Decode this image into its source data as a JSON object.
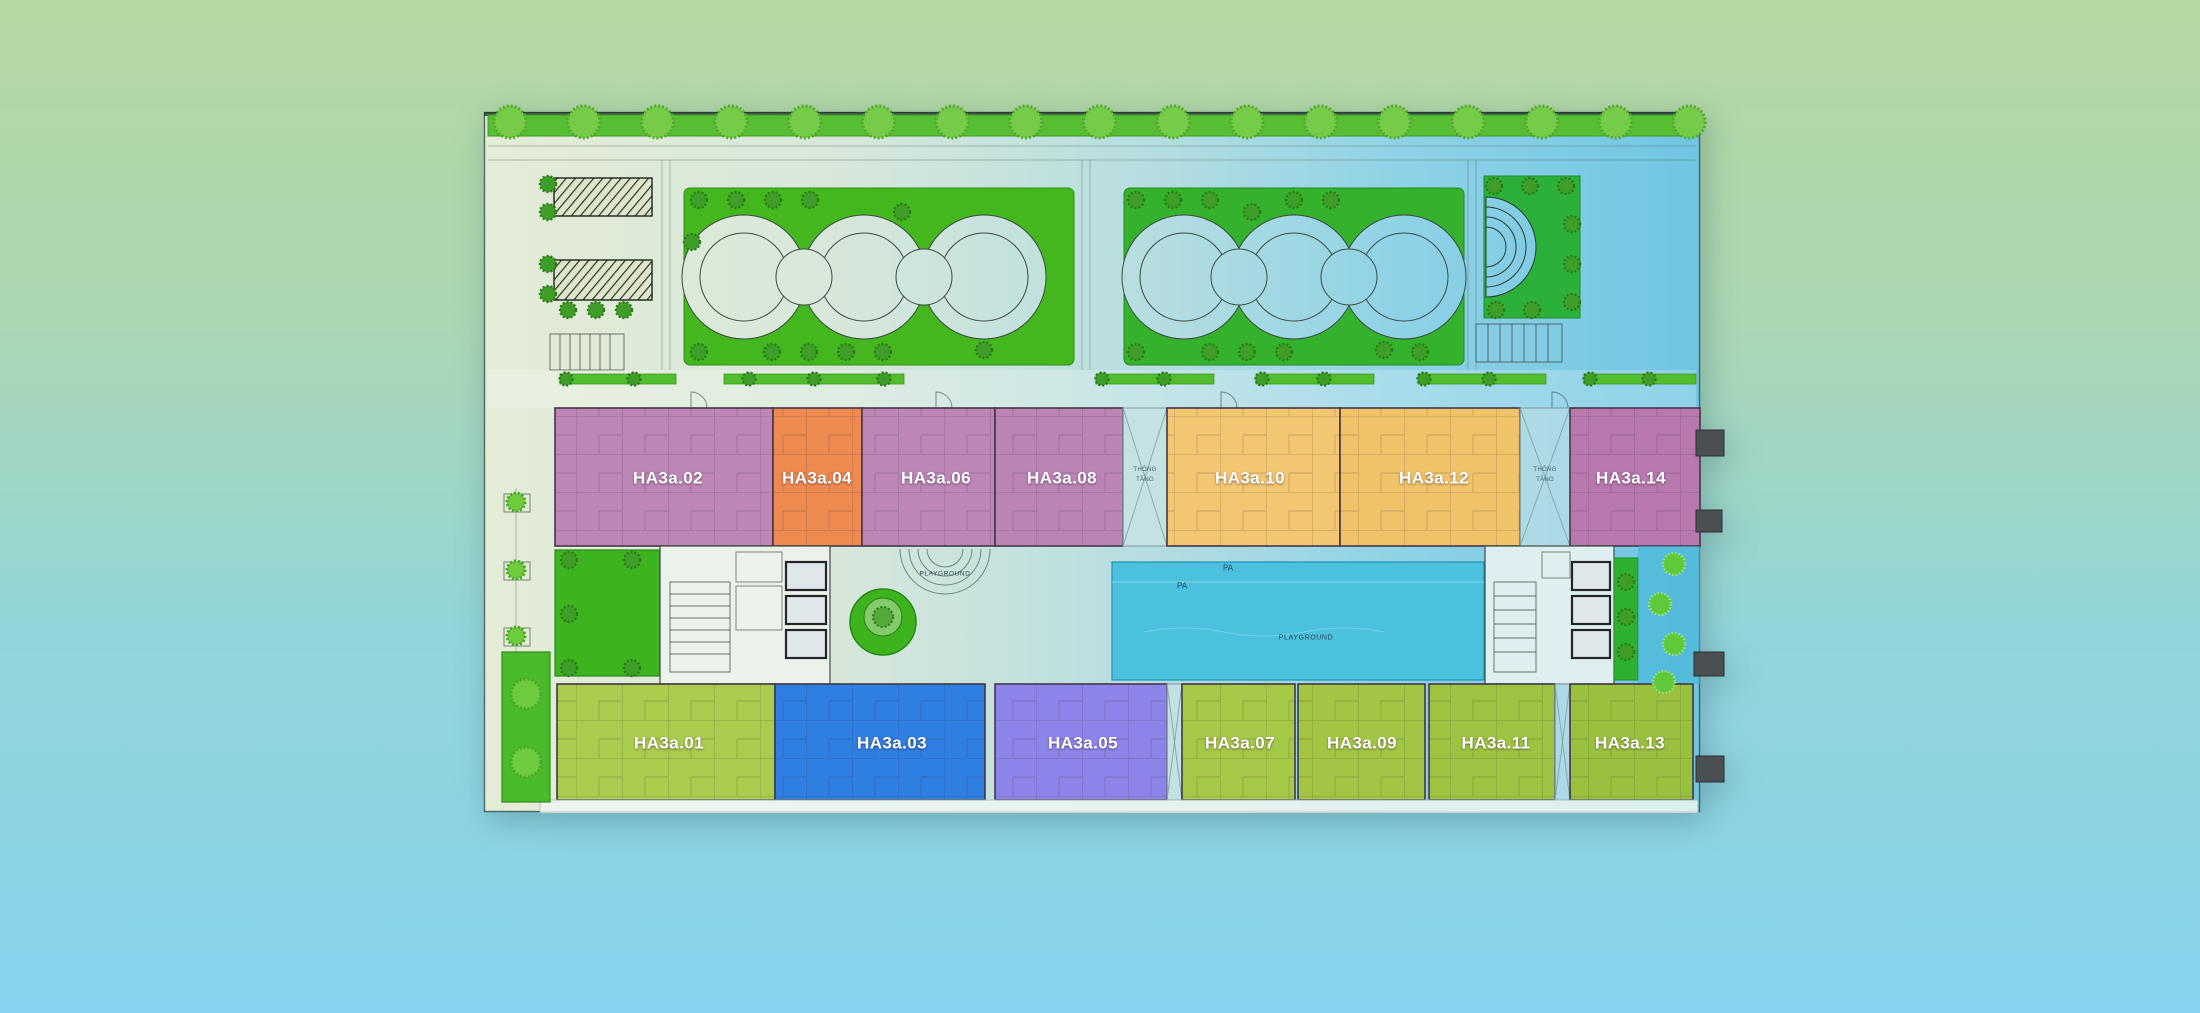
{
  "background": {
    "top_color": "#b6d7a1",
    "bottom_color": "#85d3ee"
  },
  "plan": {
    "upper_units": [
      {
        "label": "HA3a.02",
        "color": "#bd86b6"
      },
      {
        "label": "HA3a.04",
        "color": "#ee8950"
      },
      {
        "label": "HA3a.06",
        "color": "#bd86b6"
      },
      {
        "label": "HA3a.08",
        "color": "#bb84b4"
      },
      {
        "label": "HA3a.10",
        "color": "#f3c672"
      },
      {
        "label": "HA3a.12",
        "color": "#f0c369"
      },
      {
        "label": "HA3a.14",
        "color": "#b778ae"
      }
    ],
    "lower_units": [
      {
        "label": "HA3a.01",
        "color": "#aacb4d"
      },
      {
        "label": "HA3a.03",
        "color": "#2f7ee2"
      },
      {
        "label": "HA3a.05",
        "color": "#8c84e8"
      },
      {
        "label": "HA3a.07",
        "color": "#a6c847"
      },
      {
        "label": "HA3a.09",
        "color": "#a2c643"
      },
      {
        "label": "HA3a.11",
        "color": "#9ec340"
      },
      {
        "label": "HA3a.13",
        "color": "#9ac13e"
      }
    ],
    "voids": [
      {
        "label_line1": "THÔNG",
        "label_line2": "TẦNG"
      },
      {
        "label_line1": "THÔNG",
        "label_line2": "TẦNG"
      }
    ],
    "amenity": {
      "playground_garden": "PLAYGROUND",
      "playground_pool": "PLAYGROUND",
      "pa_top": "PA",
      "pa_left": "PA"
    }
  }
}
